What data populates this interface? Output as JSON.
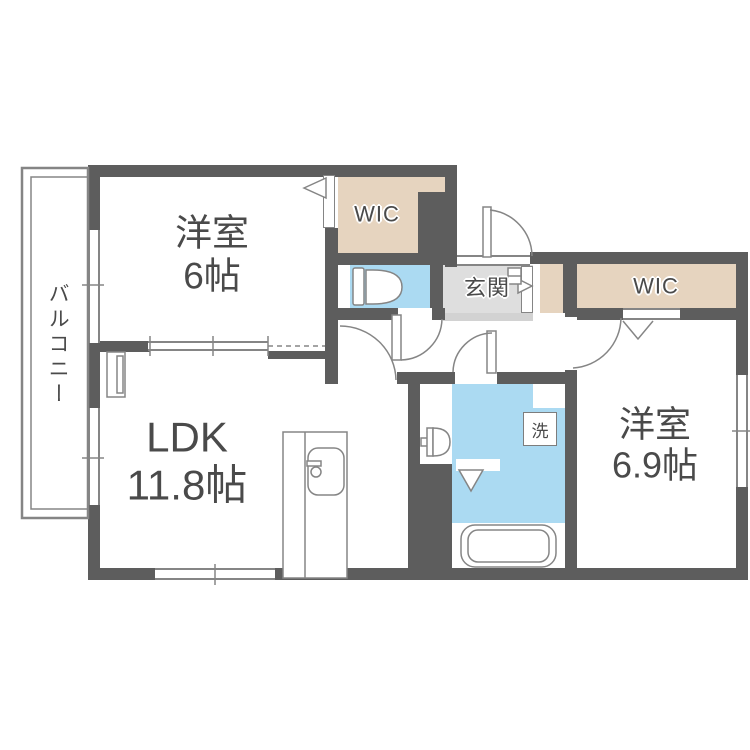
{
  "rooms": {
    "balcony": {
      "label": "バルコニー"
    },
    "bedroom1": {
      "name": "洋室",
      "size": "6帖"
    },
    "ldk": {
      "name": "LDK",
      "size": "11.8帖"
    },
    "bedroom2": {
      "name": "洋室",
      "size": "6.9帖"
    },
    "wic_top": {
      "label": "WIC"
    },
    "wic_right": {
      "label": "WIC"
    },
    "entrance": {
      "label": "玄関"
    },
    "laundry": {
      "label": "洗"
    }
  },
  "colors": {
    "wall": "#5d5d5d",
    "closet": "#e6d4bf",
    "wet": "#abdaf2",
    "entry": "#dedede",
    "step": "#d2d2d2",
    "line": "#858585"
  }
}
